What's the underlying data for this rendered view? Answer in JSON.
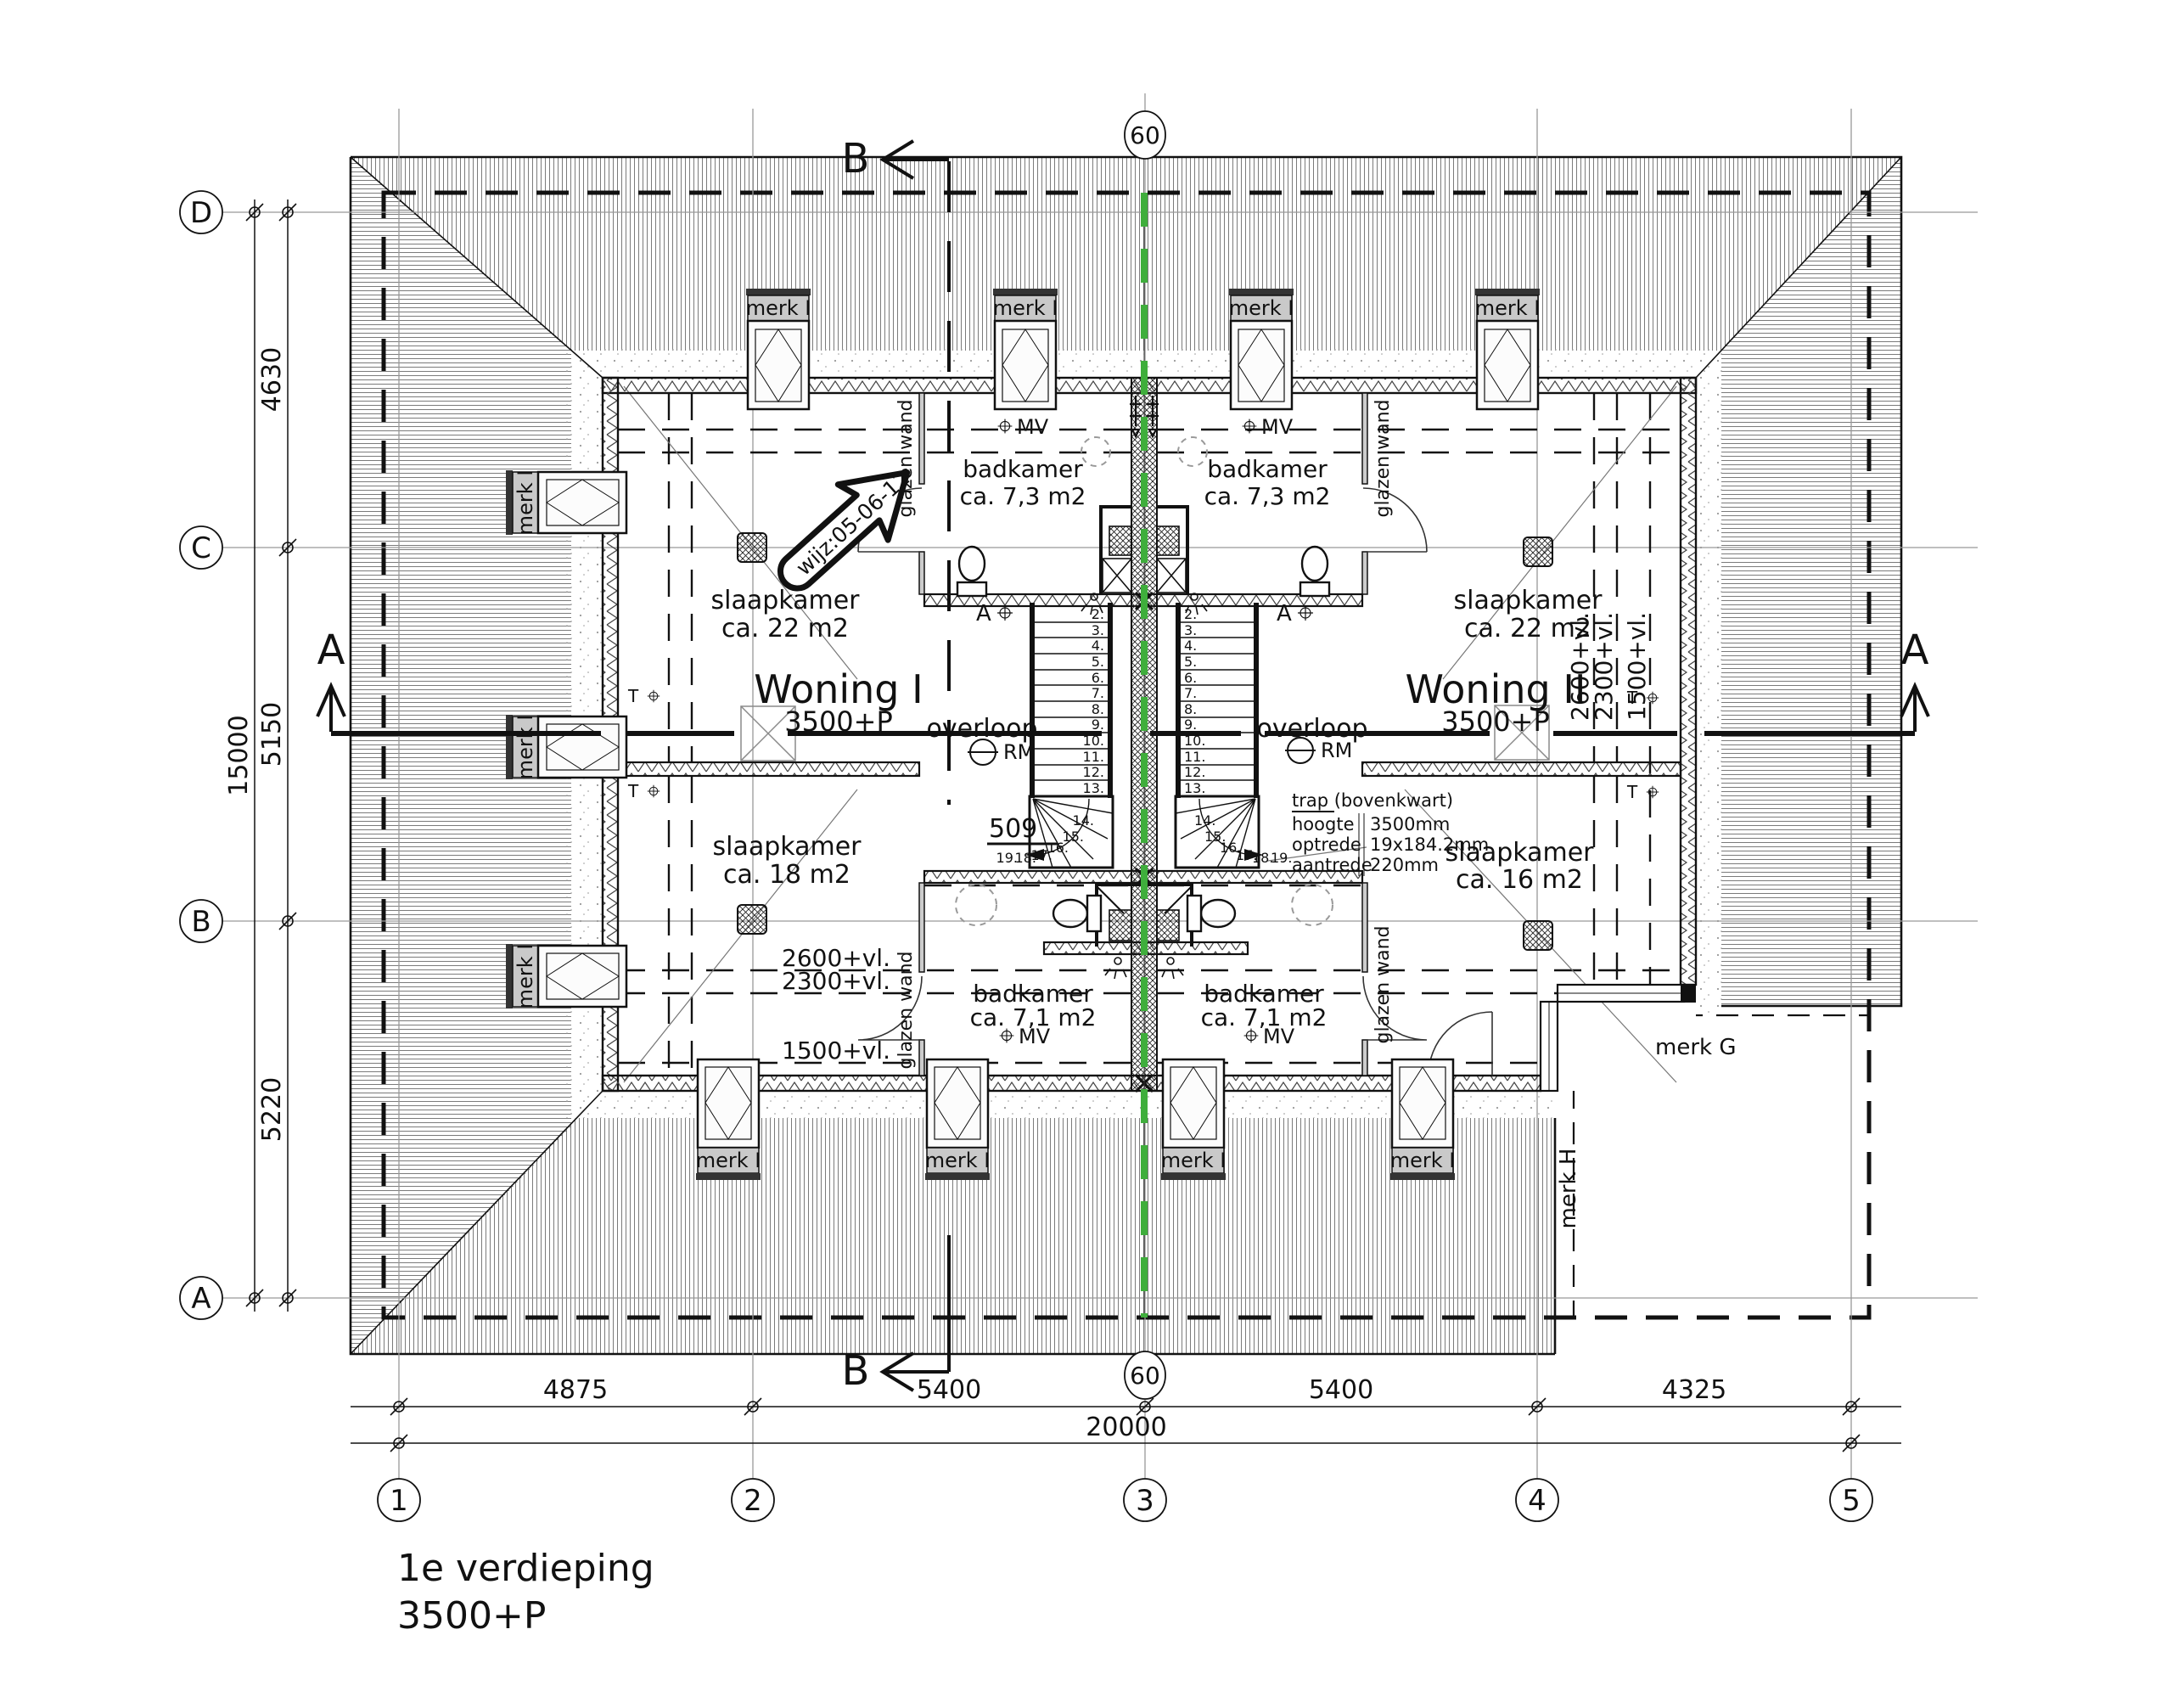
{
  "title": {
    "line1": "1e verdieping",
    "line2": "3500+P"
  },
  "grid": {
    "rows": [
      "D",
      "C",
      "B",
      "A"
    ],
    "cols": [
      "1",
      "2",
      "3",
      "4",
      "5"
    ],
    "party_axis": "60"
  },
  "dims": {
    "left": {
      "d_c": "4630",
      "c_b": "5150",
      "b_a": "5220",
      "total": "15000"
    },
    "bottom": {
      "s1": "4875",
      "s2": "5400",
      "s3": "5400",
      "s4": "4325",
      "total": "20000"
    }
  },
  "sections": {
    "a": "A",
    "b": "B"
  },
  "labels": {
    "merk_i": "merk I",
    "merk_g": "merk G",
    "merk_h": "merk H",
    "glazen_wand": "glazen wand",
    "overloop": "overloop",
    "rm": "RM",
    "mv": "MV",
    "t": "T",
    "a_marker": "A",
    "wijz": "wijz:05-06-12",
    "ref509": "509"
  },
  "rooms": {
    "badkamer_top": {
      "name": "badkamer",
      "area": "ca. 7,3 m2"
    },
    "badkamer_bottom": {
      "name": "badkamer",
      "area": "ca. 7,1 m2"
    },
    "slaapkamer_front": {
      "name": "slaapkamer",
      "area": "ca. 22 m2"
    },
    "slaapkamer_18": {
      "name": "slaapkamer",
      "area": "ca. 18 m2"
    },
    "slaapkamer_16": {
      "name": "slaapkamer",
      "area": "ca. 16 m2"
    }
  },
  "units": {
    "woning1": {
      "name": "Woning I",
      "level": "3500+P"
    },
    "woning2": {
      "name": "Woning II",
      "level": "3500+P"
    }
  },
  "heights": {
    "h2600": "2600+vl.",
    "h2300": "2300+vl.",
    "h1500": "1500+vl."
  },
  "trap": {
    "title": "trap (bovenkwart)",
    "rows": [
      {
        "k": "hoogte",
        "v": "3500mm"
      },
      {
        "k": "optrede",
        "v": "19x184.2mm"
      },
      {
        "k": "aantrede",
        "v": "220mm"
      }
    ]
  },
  "stairs": {
    "treads": [
      "2.",
      "3.",
      "4.",
      "5.",
      "6.",
      "7.",
      "8.",
      "9.",
      "10.",
      "11.",
      "12.",
      "13."
    ],
    "winders": [
      "14.",
      "15.",
      "16.",
      "17.",
      "18.",
      "19."
    ]
  },
  "colors": {
    "party_line_green": "#3fae3c",
    "label_bg": "#c9c9c9"
  }
}
